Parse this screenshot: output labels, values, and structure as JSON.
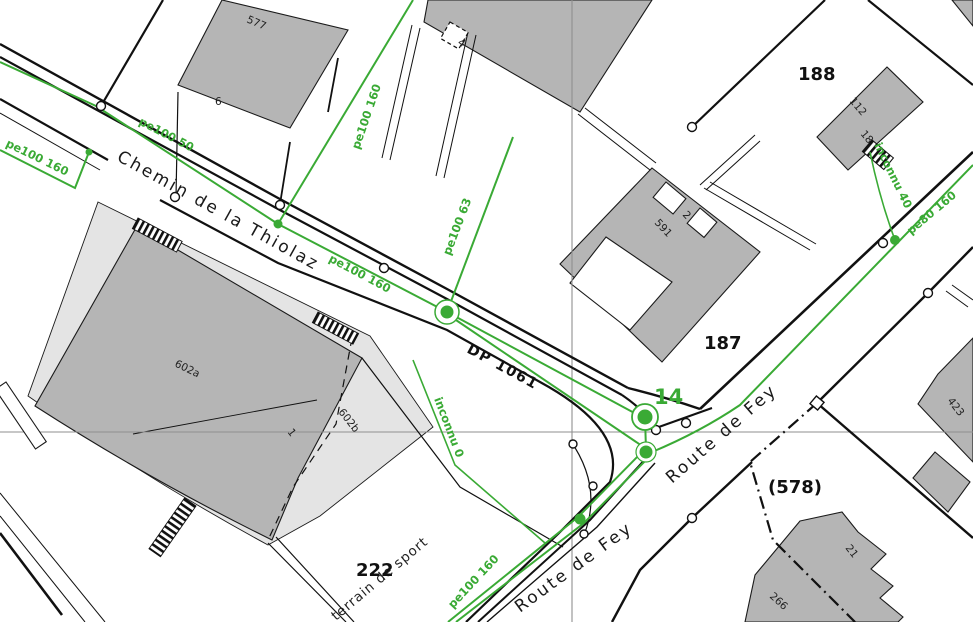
{
  "streets": {
    "chemin": "Chemin de la Thiolaz",
    "fey_upper": "Route de Fey",
    "fey_lower": "Route de Fey"
  },
  "road_ref": "DP 1061",
  "landmark": "terrain de sport",
  "parcels": {
    "p188": "188",
    "p187": "187",
    "p222": "222",
    "p578": "(578)"
  },
  "buildings": {
    "b577": "577",
    "h6": "6",
    "h4": "4",
    "b112": "112",
    "h18": "18",
    "b591": "591",
    "h2": "2",
    "b602a": "602a",
    "b602b": "602b",
    "h1": "1",
    "b21": "21",
    "b266": "266",
    "b423": "423"
  },
  "pipes": {
    "left_branch": "pe100 160",
    "upper_main": "pe100 50",
    "top_drop": "pe100 160",
    "mid_main": "pe100 160",
    "branch63": "pe100 63",
    "svc_unknown_0": "inconnu 0",
    "fey_lower": "pe100 160",
    "fey_upper": "pe80 160",
    "svc_unknown_40": "inconnu 40"
  },
  "nodes": {
    "n14": "14"
  },
  "colors": {
    "pipe_green": "#3aaa35",
    "building_gray": "#b5b5b5",
    "building_light": "#e4e4e4",
    "line_black": "#111111",
    "grid_gray": "#8f8f8f"
  }
}
